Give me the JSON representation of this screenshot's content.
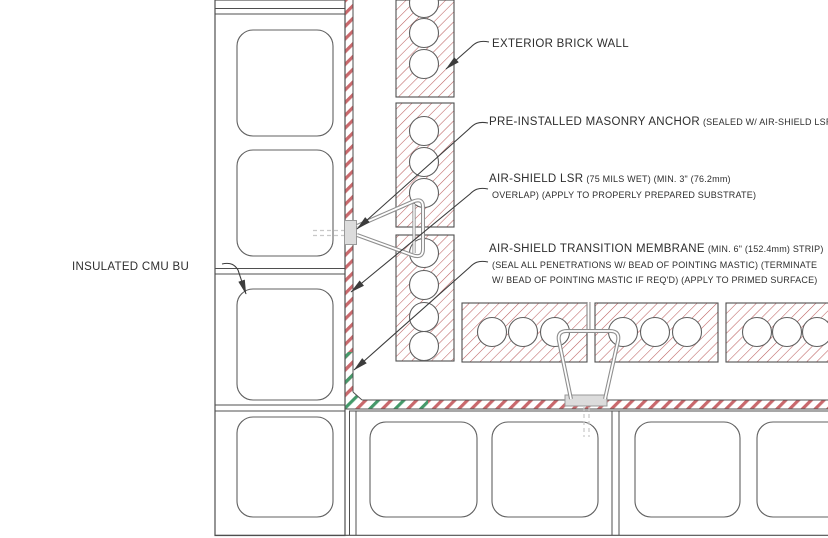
{
  "labels": {
    "exterior_brick_wall": {
      "title": "EXTERIOR BRICK WALL"
    },
    "masonry_anchor": {
      "title": "PRE-INSTALLED MASONRY ANCHOR",
      "note": "(SEALED W/ AIR-SHIELD LSR)"
    },
    "air_shield_lsr": {
      "title": "AIR-SHIELD LSR",
      "note1": "(75 MILS WET) (MIN. 3\" (76.2mm)",
      "note2": "OVERLAP) (APPLY TO PROPERLY PREPARED SUBSTRATE)"
    },
    "transition_membrane": {
      "title": "AIR-SHIELD TRANSITION MEMBRANE",
      "note1": "(MIN. 6\" (152.4mm) STRIP)",
      "note2": "(SEAL ALL PENETRATIONS W/ BEAD OF POINTING MASTIC) (TERMINATE",
      "note3": "W/ BEAD OF POINTING MASTIC IF REQ'D) (APPLY TO PRIMED SURFACE)"
    },
    "insulated_cmu": {
      "title": "INSULATED CMU BU"
    }
  },
  "colors": {
    "line": "#4f4f4f",
    "cell-line": "#606060",
    "hatch-red": "#bc6060",
    "mem-red": "#c9686c",
    "mem-green": "#44996a",
    "wire": "#8f8f8f",
    "hidden-line": "#c8c8c8",
    "leader": "#3c3c3c",
    "text": "#2e2e2e"
  }
}
